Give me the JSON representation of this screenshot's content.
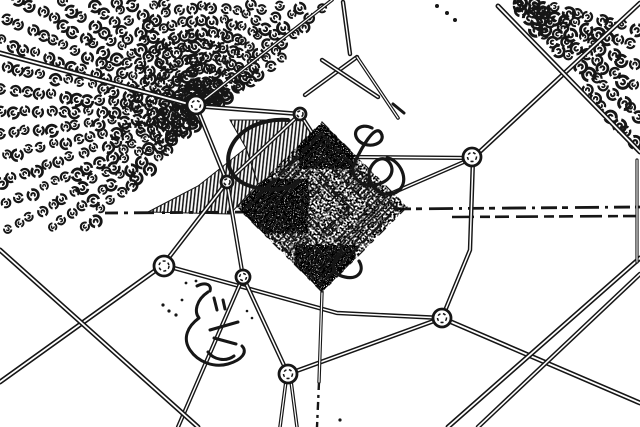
{
  "image": {
    "description": "Black-and-white edge-detected aerial view of a guyed tower structure seen from directly above: a dense stippled diamond core with concentric square outlines, guy wires radiating to circular anchor rings, long roads crossing the lower field, orchard rows of scribbled tree blobs in the upper-left and upper-right corners, dashed field lines across the middle, and small ground squiggle marks.",
    "width": 640,
    "height": 427
  },
  "palette": {
    "background": "#ffffff",
    "ink": "#161616"
  },
  "scene": {
    "tower": {
      "cx": 322,
      "cy": 207,
      "half": 85,
      "rings": [
        {
          "h": 12,
          "w": 1.5,
          "dash": "8 3 14 4"
        },
        {
          "h": 24,
          "w": 2.1,
          "dash": "5 4 10 3"
        },
        {
          "h": 36,
          "w": 1.5,
          "dash": "12 5 6 3"
        },
        {
          "h": 48,
          "w": 2.2,
          "dash": "7 2 16 6"
        },
        {
          "h": 62,
          "w": 1.6,
          "dash": "9 4 4 3"
        },
        {
          "h": 76,
          "w": 2.4,
          "dash": "14 6 8 4"
        }
      ],
      "hatch_rings": [
        {
          "outer": 76,
          "inner": 48,
          "pattern": "hatch45"
        },
        {
          "outer": 34,
          "inner": 20,
          "pattern": "hatch135"
        }
      ],
      "stipple_rects": [
        {
          "x": 237,
          "y": 122,
          "w": 172,
          "h": 172,
          "filter": "stipple1"
        },
        {
          "x": 243,
          "y": 180,
          "w": 64,
          "h": 52,
          "filter": "stipple2"
        },
        {
          "x": 296,
          "y": 246,
          "w": 58,
          "h": 48,
          "filter": "stipple2"
        },
        {
          "x": 300,
          "y": 126,
          "w": 52,
          "h": 42,
          "filter": "stipple2"
        }
      ]
    },
    "nodes": [
      {
        "x": 196,
        "y": 105,
        "r": 9
      },
      {
        "x": 300,
        "y": 114,
        "r": 6
      },
      {
        "x": 472,
        "y": 157,
        "r": 9
      },
      {
        "x": 442,
        "y": 318,
        "r": 9
      },
      {
        "x": 288,
        "y": 374,
        "r": 9
      },
      {
        "x": 164,
        "y": 266,
        "r": 10
      },
      {
        "x": 227,
        "y": 182,
        "r": 6
      },
      {
        "x": 243,
        "y": 277,
        "r": 7
      }
    ],
    "wires": [
      {
        "pts": [
          [
            0,
            53
          ],
          [
            196,
            106
          ]
        ],
        "w": 5.2,
        "core": 1.9,
        "type": "road"
      },
      {
        "pts": [
          [
            196,
            106
          ],
          [
            300,
            114
          ]
        ],
        "w": 4.6,
        "core": 1.6,
        "type": "wire"
      },
      {
        "pts": [
          [
            196,
            106
          ],
          [
            227,
            182
          ]
        ],
        "w": 4.4,
        "core": 1.5,
        "type": "wire"
      },
      {
        "pts": [
          [
            227,
            182
          ],
          [
            163,
            265
          ]
        ],
        "w": 4.6,
        "core": 1.6,
        "type": "wire"
      },
      {
        "pts": [
          [
            227,
            182
          ],
          [
            243,
            277
          ]
        ],
        "w": 4.2,
        "core": 1.5,
        "type": "wire"
      },
      {
        "pts": [
          [
            227,
            182
          ],
          [
            300,
            114
          ]
        ],
        "w": 4.2,
        "core": 1.5,
        "type": "wire"
      },
      {
        "pts": [
          [
            163,
            265
          ],
          [
            0,
            382
          ]
        ],
        "w": 5.0,
        "core": 1.8,
        "type": "wire"
      },
      {
        "pts": [
          [
            163,
            265
          ],
          [
            337,
            313
          ],
          [
            442,
            318
          ]
        ],
        "w": 4.4,
        "core": 1.5,
        "type": "road"
      },
      {
        "pts": [
          [
            243,
            277
          ],
          [
            288,
            374
          ]
        ],
        "w": 4.4,
        "core": 1.5,
        "type": "wire"
      },
      {
        "pts": [
          [
            243,
            277
          ],
          [
            178,
            427
          ]
        ],
        "w": 4.2,
        "core": 1.4,
        "type": "wire"
      },
      {
        "pts": [
          [
            286,
            381
          ],
          [
            280,
            427
          ]
        ],
        "w": 3.6,
        "core": 1.2,
        "type": "wire"
      },
      {
        "pts": [
          [
            291,
            381
          ],
          [
            297,
            427
          ]
        ],
        "w": 3.6,
        "core": 1.2,
        "type": "wire"
      },
      {
        "pts": [
          [
            442,
            318
          ],
          [
            288,
            374
          ]
        ],
        "w": 4.6,
        "core": 1.6,
        "type": "wire"
      },
      {
        "pts": [
          [
            442,
            318
          ],
          [
            640,
            403
          ]
        ],
        "w": 5.0,
        "core": 1.8,
        "type": "road"
      },
      {
        "pts": [
          [
            442,
            318
          ],
          [
            470,
            250
          ],
          [
            473,
            158
          ]
        ],
        "w": 4.4,
        "core": 1.5,
        "type": "wire"
      },
      {
        "pts": [
          [
            473,
            158
          ],
          [
            640,
            3
          ]
        ],
        "w": 4.8,
        "core": 1.7,
        "type": "wire"
      },
      {
        "pts": [
          [
            473,
            158
          ],
          [
            350,
            157
          ]
        ],
        "w": 4.2,
        "core": 1.4,
        "type": "wire"
      },
      {
        "pts": [
          [
            473,
            158
          ],
          [
            390,
            194
          ]
        ],
        "w": 4.2,
        "core": 1.4,
        "type": "wire"
      },
      {
        "pts": [
          [
            300,
            114
          ],
          [
            318,
            142
          ]
        ],
        "w": 4.2,
        "core": 1.4,
        "type": "wire"
      },
      {
        "pts": [
          [
            196,
            106
          ],
          [
            332,
            0
          ]
        ],
        "w": 3.6,
        "core": 1.2,
        "type": "wire"
      },
      {
        "pts": [
          [
            0,
            250
          ],
          [
            198,
            427
          ]
        ],
        "w": 5.0,
        "core": 1.8,
        "type": "road"
      },
      {
        "pts": [
          [
            640,
            258
          ],
          [
            448,
            427
          ]
        ],
        "w": 5.0,
        "core": 1.8,
        "type": "road"
      },
      {
        "pts": [
          [
            640,
            274
          ],
          [
            478,
            427
          ]
        ],
        "w": 4.6,
        "core": 1.6,
        "type": "road"
      },
      {
        "pts": [
          [
            498,
            6
          ],
          [
            640,
            152
          ]
        ],
        "w": 5.0,
        "core": 1.8,
        "type": "road"
      },
      {
        "pts": [
          [
            322,
            292
          ],
          [
            319,
            382
          ]
        ],
        "w": 3.4,
        "core": 1.2,
        "type": "wire"
      },
      {
        "pts": [
          [
            305,
            95
          ],
          [
            357,
            57
          ]
        ],
        "w": 4.4,
        "core": 1.4,
        "type": "wire"
      },
      {
        "pts": [
          [
            322,
            60
          ],
          [
            378,
            97
          ]
        ],
        "w": 4.4,
        "core": 1.4,
        "type": "wire"
      },
      {
        "pts": [
          [
            343,
            2
          ],
          [
            350,
            54
          ]
        ],
        "w": 4.4,
        "core": 1.4,
        "type": "wire"
      },
      {
        "pts": [
          [
            357,
            57
          ],
          [
            398,
            118
          ]
        ],
        "w": 3.6,
        "core": 1.2,
        "type": "wire"
      },
      {
        "pts": [
          [
            637,
            160
          ],
          [
            637,
            262
          ]
        ],
        "w": 3.2,
        "core": 1.1,
        "type": "wire"
      }
    ],
    "dashed_lines": [
      {
        "pts": [
          [
            105,
            213
          ],
          [
            258,
            212
          ]
        ],
        "w": 2.8,
        "dash": "13 6 4 6 20 8 3 5"
      },
      {
        "pts": [
          [
            395,
            209
          ],
          [
            640,
            207
          ]
        ],
        "w": 2.8,
        "dash": "16 5 6 7 24 6 3 6"
      },
      {
        "pts": [
          [
            452,
            217
          ],
          [
            640,
            216
          ]
        ],
        "w": 2.6,
        "dash": "22 6 10 5 14 7"
      },
      {
        "pts": [
          [
            319,
            382
          ],
          [
            317,
            427
          ]
        ],
        "w": 2.4,
        "dash": "8 5 3 4"
      }
    ],
    "orchards": [
      {
        "name": "northwest-grove",
        "polygon": [
          [
            0,
            0
          ],
          [
            332,
            0
          ],
          [
            228,
            122
          ],
          [
            246,
            148
          ],
          [
            200,
            186
          ],
          [
            100,
            227
          ],
          [
            0,
            238
          ]
        ],
        "focus": [
          205,
          112
        ],
        "angle_start": 325,
        "angle_end": 135,
        "angle_step": -6.3,
        "r_start": 17,
        "r_step": 12.5,
        "r_max": 262,
        "blob_scale": 1.0,
        "seed": 3
      },
      {
        "name": "northeast-grove",
        "polygon": [
          [
            508,
            0
          ],
          [
            640,
            0
          ],
          [
            640,
            154
          ]
        ],
        "focus": [
          494,
          -6
        ],
        "angle_start": 14,
        "angle_end": 86,
        "angle_step": 6.5,
        "r_start": 18,
        "r_step": 11.5,
        "r_max": 238,
        "blob_scale": 1.1,
        "seed": 17
      }
    ],
    "hatch_wedges": [
      {
        "points": "230,120 305,120 320,146 258,184 246,148"
      },
      {
        "points": "246,148 258,184 230,214 148,212 198,186"
      }
    ],
    "scribbles": [
      {
        "name": "crescent-arc",
        "d": "M 288,120 C 230,116 208,172 250,186 C 268,192 288,190 297,182",
        "w": 4
      },
      {
        "name": "bush-scribble",
        "d": "M 372,128 C 360,122 350,132 359,141 C 369,150 387,143 381,133 C 375,123 361,149 355,162 C 348,175 360,187 374,185 C 390,183 397,170 388,161 C 379,153 365,168 370,181 C 375,195 393,199 401,188 C 409,177 398,159 387,158",
        "w": 3.2
      },
      {
        "name": "ground-mark-loop",
        "d": "M 197,286 C 205,282 212,284 210,291 M 208,292 C 196,300 194,312 199,318 C 188,326 182,338 190,350 C 198,362 214,368 228,364 C 242,360 248,352 242,346 M 210,330 L 238,322 M 214,338 l 22,6 m -28,8 c 6,8 18,10 26,4 M 214,298 l 3,12 m 6,-10 l 2,9",
        "w": 3
      },
      {
        "name": "hook-mark",
        "d": "M 342,252 C 329,263 331,274 345,277 C 358,280 365,271 359,261",
        "w": 3.2
      },
      {
        "name": "small-dash",
        "d": "M 393,104 L 404,113",
        "w": 3
      }
    ],
    "dots": [
      [
        437,
        6,
        2
      ],
      [
        447,
        13,
        2
      ],
      [
        455,
        20,
        2
      ],
      [
        163,
        305,
        1.6
      ],
      [
        169,
        311,
        1.6
      ],
      [
        176,
        315,
        1.6
      ],
      [
        182,
        300,
        1.4
      ],
      [
        186,
        283,
        1.4
      ],
      [
        196,
        281,
        1.4
      ],
      [
        340,
        420,
        1.6
      ],
      [
        247,
        311,
        1.3
      ],
      [
        252,
        318,
        1.3
      ]
    ]
  }
}
